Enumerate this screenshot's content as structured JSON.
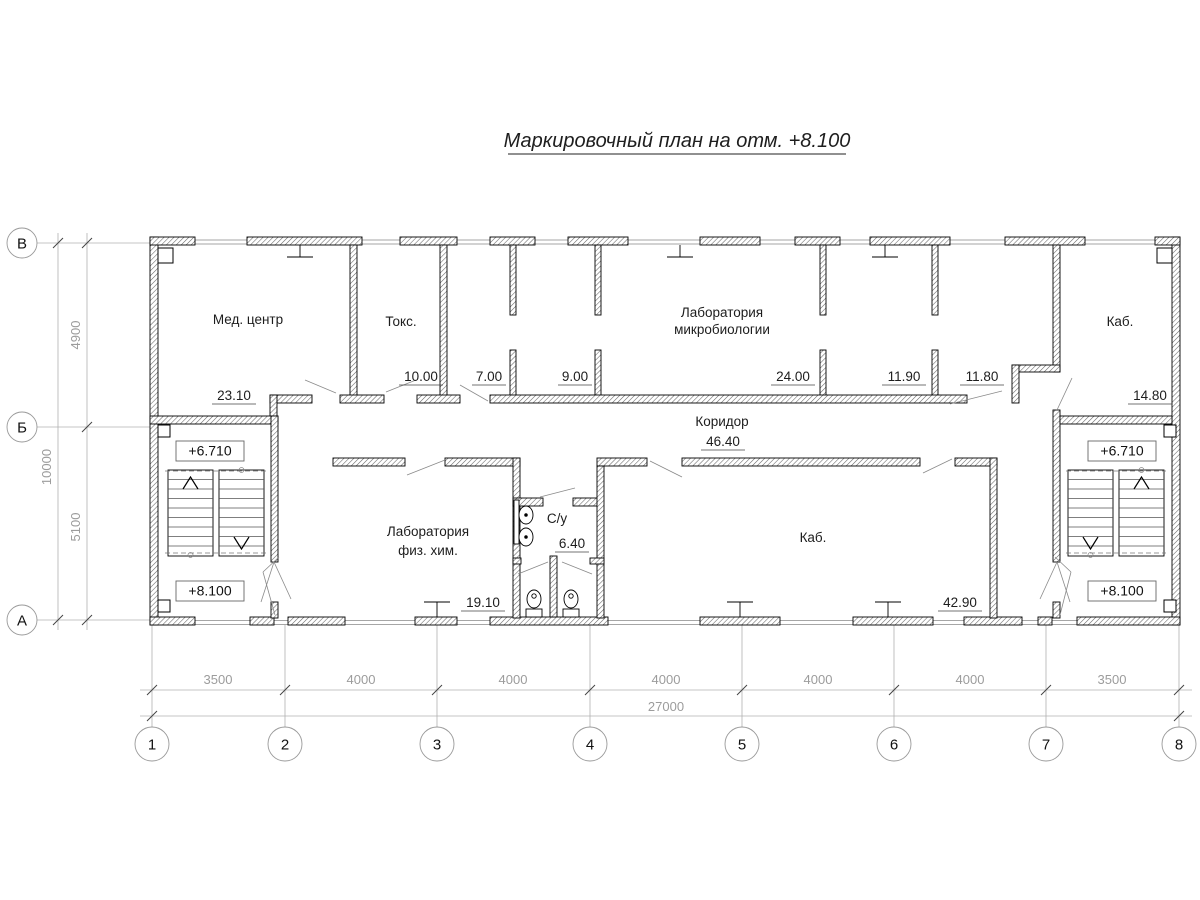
{
  "title": "Маркировочный план на отм. +8.100",
  "axes": {
    "rows": [
      "В",
      "Б",
      "А"
    ],
    "cols": [
      "1",
      "2",
      "3",
      "4",
      "5",
      "6",
      "7",
      "8"
    ]
  },
  "dimensions": {
    "left": {
      "segments": [
        "4900",
        "5100"
      ],
      "total": "10000"
    },
    "bottom": {
      "segments": [
        "3500",
        "4000",
        "4000",
        "4000",
        "4000",
        "4000",
        "3500"
      ],
      "total": "27000"
    }
  },
  "elevations": {
    "upper": "+6.710",
    "lower": "+8.100"
  },
  "rooms": {
    "med_center": {
      "name": "Мед. центр",
      "area": "23.10"
    },
    "toks": {
      "name": "Токс.",
      "area": "10.00"
    },
    "room7": {
      "area": "7.00"
    },
    "room9": {
      "area": "9.00"
    },
    "micro_lab": {
      "name_line1": "Лаборатория",
      "name_line2": "микробиологии",
      "area": "24.00"
    },
    "room1190": {
      "area": "11.90"
    },
    "room1180": {
      "area": "11.80"
    },
    "kab_right": {
      "name": "Каб.",
      "area": "14.80"
    },
    "corridor": {
      "name": "Коридор",
      "area": "46.40"
    },
    "phys_lab": {
      "name_line1": "Лаборатория",
      "name_line2": "физ. хим.",
      "area": "19.10"
    },
    "wc": {
      "name": "С/у",
      "area": "6.40"
    },
    "kab_main": {
      "name": "Каб.",
      "area": "42.90"
    }
  }
}
